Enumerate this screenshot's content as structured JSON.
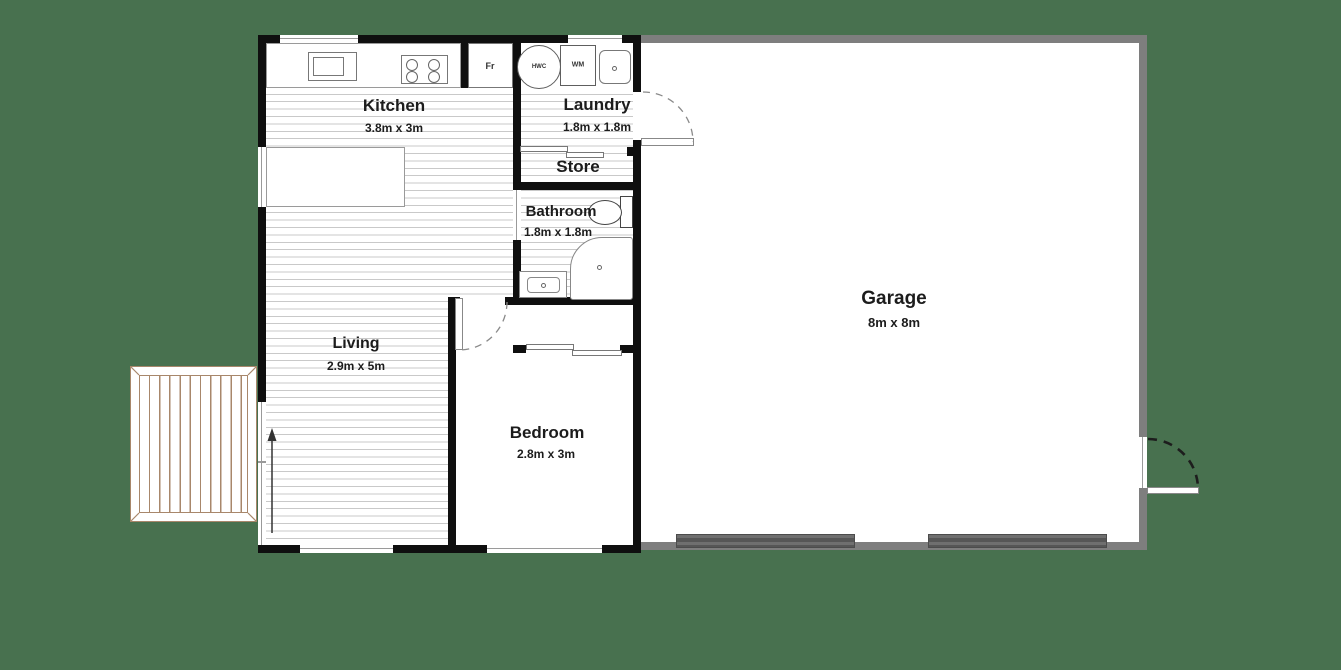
{
  "title": "Granny flat floor plan with garage",
  "rooms": {
    "kitchen": {
      "name": "Kitchen",
      "dims": "3.8m x 3m"
    },
    "laundry": {
      "name": "Laundry",
      "dims": "1.8m x 1.8m"
    },
    "store": {
      "name": "Store"
    },
    "bathroom": {
      "name": "Bathroom",
      "dims": "1.8m x 1.8m"
    },
    "living": {
      "name": "Living",
      "dims": "2.9m x 5m"
    },
    "bedroom": {
      "name": "Bedroom",
      "dims": "2.8m x 3m"
    },
    "garage": {
      "name": "Garage",
      "dims": "8m x 8m"
    }
  },
  "fixtures": {
    "fridge": "Fr",
    "hot_water_cylinder": "HWC",
    "washing_machine": "WM"
  },
  "icons": [
    "kitchen-sink-icon",
    "cooktop-icon",
    "fridge-icon",
    "island-bench-icon",
    "hot-water-cylinder-icon",
    "washing-machine-icon",
    "laundry-tub-icon",
    "toilet-icon",
    "shower-icon",
    "vanity-icon",
    "wood-deck-icon",
    "door-swing-icon",
    "sliding-door-icon",
    "window-icon",
    "entry-arrow-icon",
    "garage-door-icon"
  ],
  "colors": {
    "background": "#48714f",
    "house_wall": "#0f0f0f",
    "garage_wall": "#7e7e7e",
    "floor_stripe": "#c9c9c9",
    "deck_timber": "#a8876b",
    "garage_door": "#5f5f5f",
    "text": "#1c1c1c"
  }
}
